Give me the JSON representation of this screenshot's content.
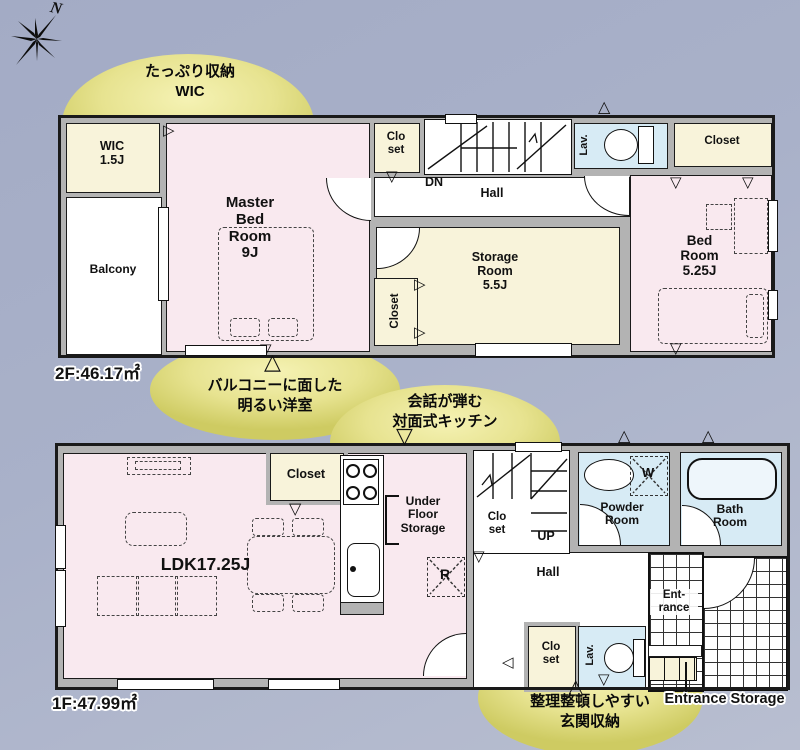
{
  "compass": {
    "n": "N"
  },
  "callouts": {
    "wic": "たっぷり収納\nWIC",
    "balcony": "バルコニーに面した\n明るい洋室",
    "kitchen": "会話が弾む\n対面式キッチン",
    "entrance": "整理整頓しやすい\n玄関収納"
  },
  "floor2": {
    "area_label": "2F:46.17㎡",
    "rooms": {
      "wic": "WIC\n1.5J",
      "balcony": "Balcony",
      "master_bedroom": "Master\nBed\nRoom\n9J",
      "closet_top": "Clo\nset",
      "stairs_dn": "DN",
      "hall": "Hall",
      "lav": "Lav.",
      "closet_right": "Closet",
      "bedroom": "Bed\nRoom\n5.25J",
      "storage_room": "Storage\nRoom\n5.5J",
      "closet_mid": "Closet"
    }
  },
  "floor1": {
    "area_label": "1F:47.99㎡",
    "rooms": {
      "ldk": "LDK17.25J",
      "closet": "Closet",
      "under_floor_storage": "Under\nFloor\nStorage",
      "refrigerator": "R",
      "closet_upper": "Clo\nset",
      "stairs_up": "UP",
      "hall": "Hall",
      "powder_room": "Powder\nRoom",
      "washer": "W",
      "bath_room": "Bath\nRoom",
      "entrance": "Ent-\nrance",
      "closet_lower": "Clo\nset",
      "lav": "Lav.",
      "entrance_storage": "Entrance Storage"
    }
  }
}
